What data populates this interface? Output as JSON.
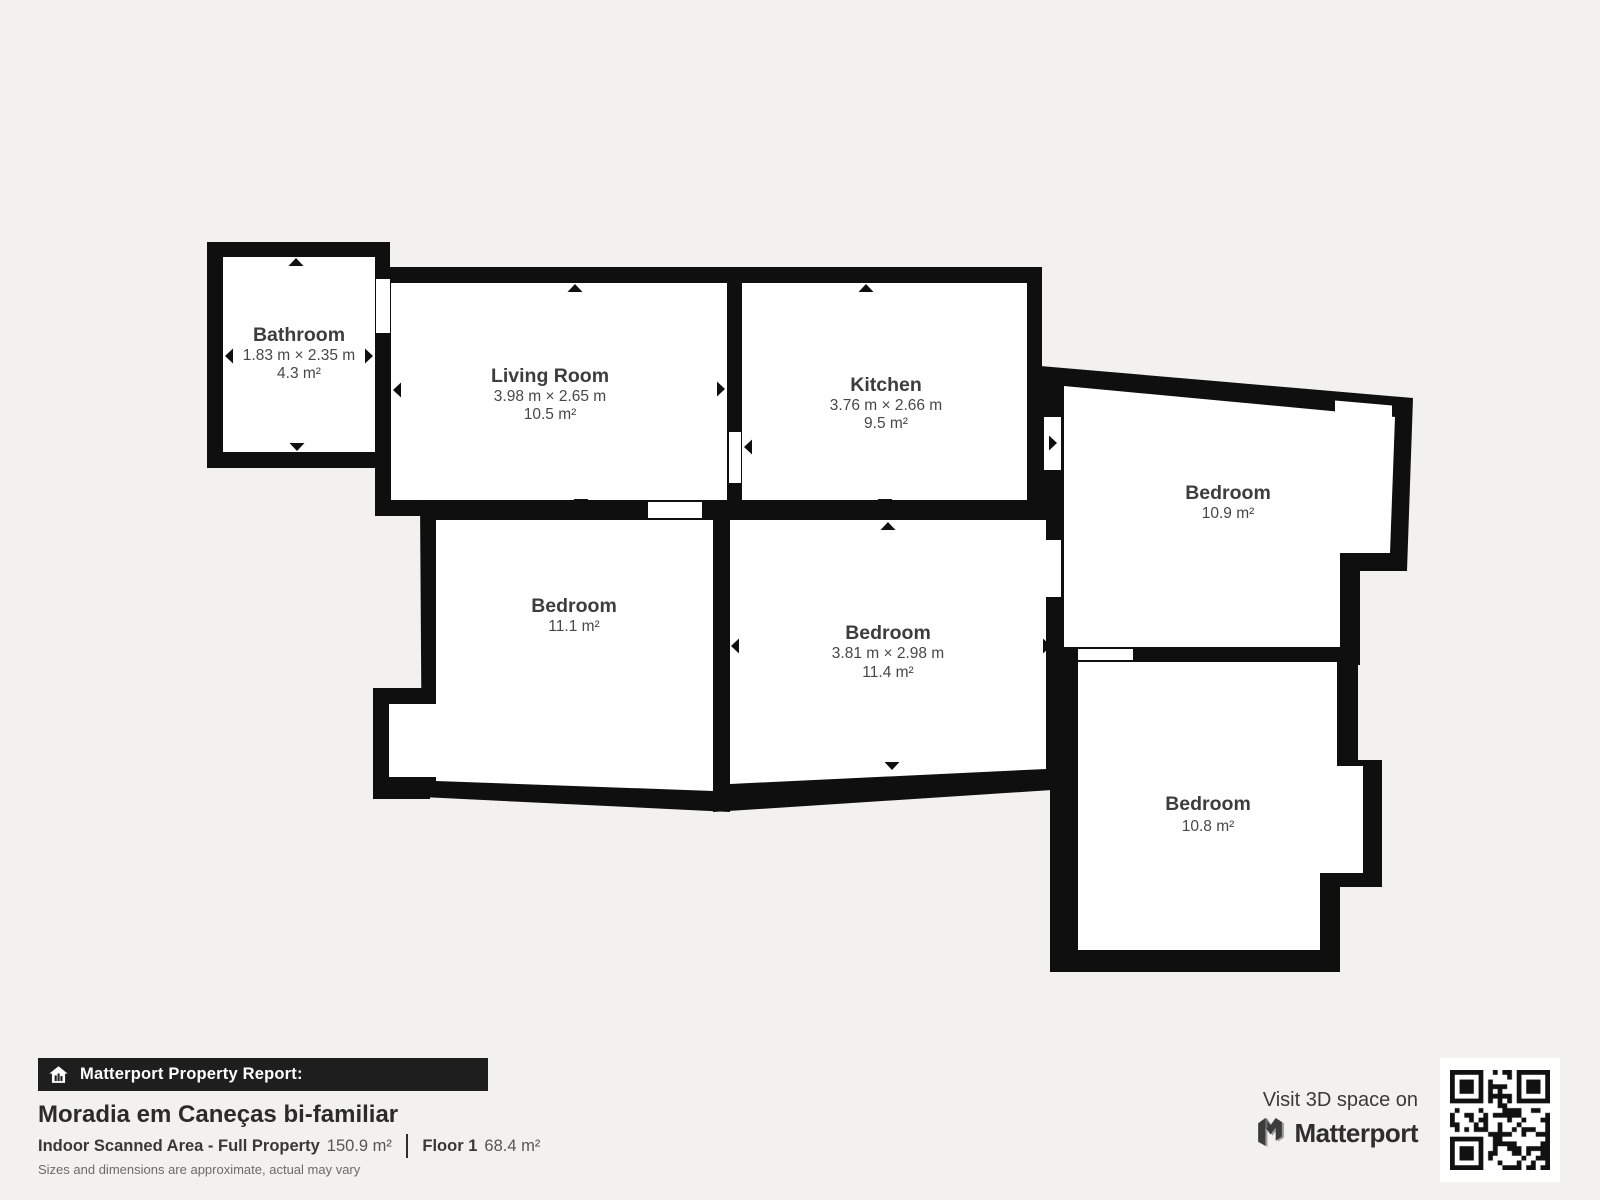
{
  "rooms": [
    {
      "name": "Bathroom",
      "dims": "1.83 m × 2.35 m",
      "area": "4.3 m²"
    },
    {
      "name": "Living Room",
      "dims": "3.98 m × 2.65 m",
      "area": "10.5 m²"
    },
    {
      "name": "Kitchen",
      "dims": "3.76 m × 2.66 m",
      "area": "9.5 m²"
    },
    {
      "name": "Bedroom",
      "area": "10.9 m²"
    },
    {
      "name": "Bedroom",
      "area": "11.1 m²"
    },
    {
      "name": "Bedroom",
      "dims": "3.81 m × 2.98 m",
      "area": "11.4 m²"
    },
    {
      "name": "Bedroom",
      "area": "10.8 m²"
    }
  ],
  "report": {
    "banner": "Matterport Property Report:",
    "title": "Moradia em Caneças bi-familiar",
    "scanned_area_label": "Indoor Scanned Area - Full Property",
    "scanned_area_value": "150.9 m²",
    "floor_label": "Floor 1",
    "floor_value": "68.4 m²",
    "disclaimer": "Sizes and dimensions are approximate, actual may vary"
  },
  "cta": {
    "visit_text": "Visit 3D space on",
    "brand": "Matterport"
  },
  "icons": {
    "banner_icon": "house-bars-icon",
    "brand_icon": "matterport-m-icon",
    "qr": "qr-code"
  },
  "colors": {
    "background": "#f2f1ee",
    "wall": "#0f0f0f",
    "room_fill": "#ffffff",
    "room_text": "#414141",
    "banner_bg": "#1e1e1e",
    "banner_text": "#ffffff"
  }
}
